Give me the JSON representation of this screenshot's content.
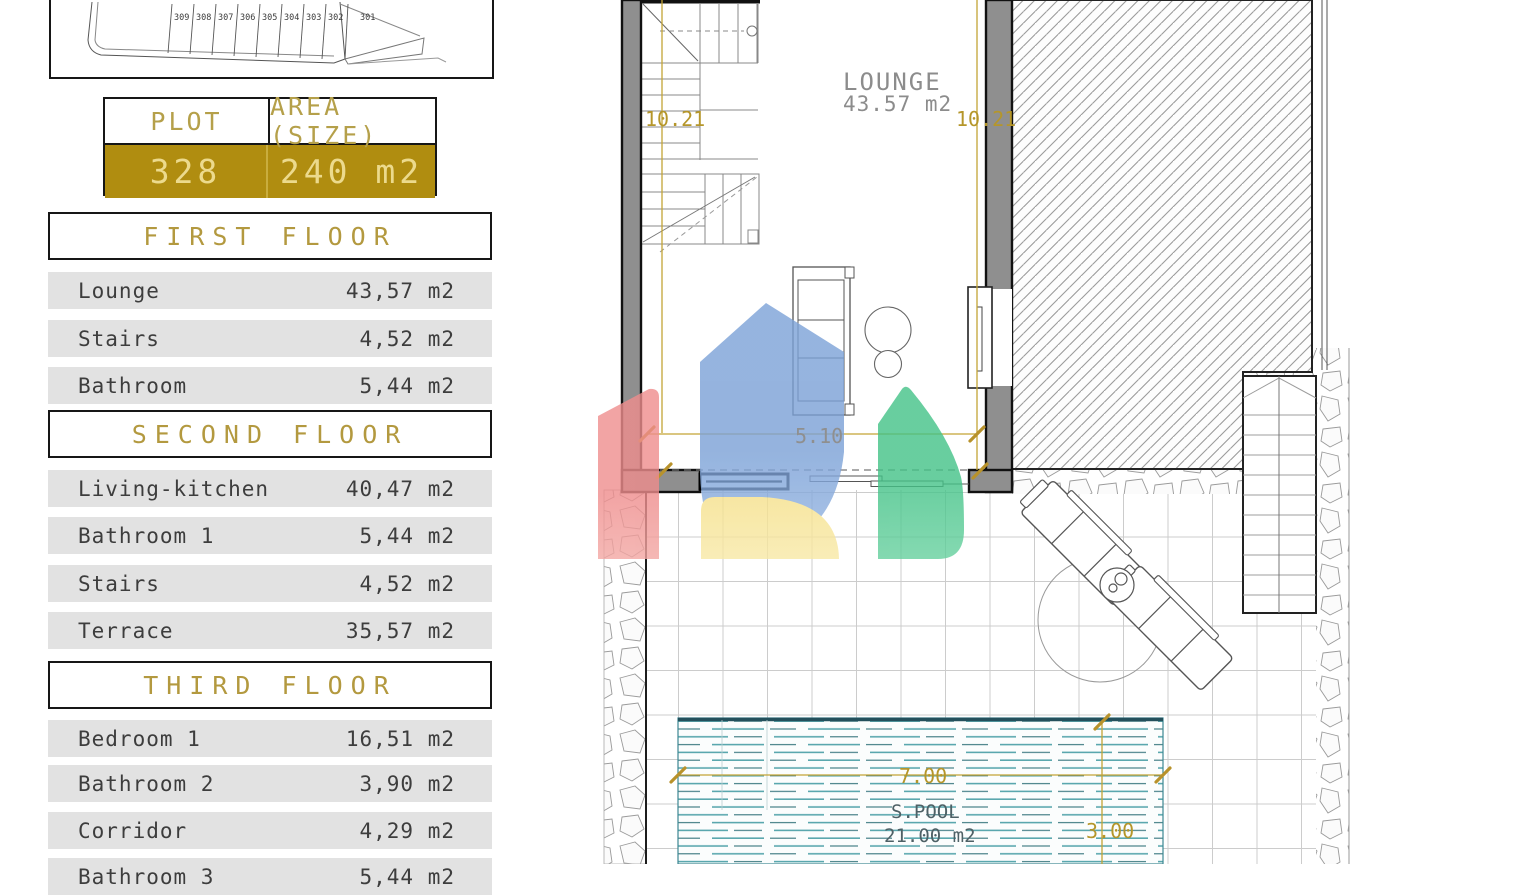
{
  "site_plan": {
    "plots": [
      "309",
      "308",
      "307",
      "306",
      "305",
      "304",
      "303",
      "302",
      "301"
    ]
  },
  "plot_table": {
    "header_plot": "PLOT",
    "header_area": "AREA (SIZE)",
    "plot_number": "328",
    "area": "240 m2"
  },
  "floors": [
    {
      "title": "FIRST FLOOR",
      "rows": [
        {
          "label": "Lounge",
          "area": "43,57 m2"
        },
        {
          "label": "Stairs",
          "area": "4,52 m2"
        },
        {
          "label": "Bathroom",
          "area": "5,44 m2"
        }
      ]
    },
    {
      "title": "SECOND FLOOR",
      "rows": [
        {
          "label": "Living-kitchen",
          "area": "40,47 m2"
        },
        {
          "label": "Bathroom 1",
          "area": "5,44 m2"
        },
        {
          "label": "Stairs",
          "area": "4,52 m2"
        },
        {
          "label": "Terrace",
          "area": "35,57 m2"
        }
      ]
    },
    {
      "title": "THIRD FLOOR",
      "rows": [
        {
          "label": "Bedroom 1",
          "area": "16,51 m2"
        },
        {
          "label": "Bathroom 2",
          "area": "3,90 m2"
        },
        {
          "label": "Corridor",
          "area": "4,29 m2"
        },
        {
          "label": "Bathroom 3",
          "area": "5,44 m2"
        }
      ]
    }
  ],
  "plan": {
    "room_label": "LOUNGE",
    "room_area": "43.57 m2",
    "pool_label": "S.POOL",
    "pool_area": "21.00 m2",
    "dim_left": "10.21",
    "dim_right": "10.21",
    "dim_width": "5.10",
    "dim_pool_width": "7.00",
    "dim_pool_depth": "3.00"
  },
  "colors": {
    "gold_accent": "#b5962a",
    "plot_row_bg": "#b08d10",
    "plot_row_text": "#ecda8d",
    "table_row_bg": "#e2e2e2",
    "wall_gray": "#8f8f8f",
    "pool_water": "#5aa7ae",
    "watermark_red": "#ef8d8d",
    "watermark_blue": "#7ba1d7",
    "watermark_green": "#43c287",
    "watermark_yellow": "#f6e18c"
  }
}
